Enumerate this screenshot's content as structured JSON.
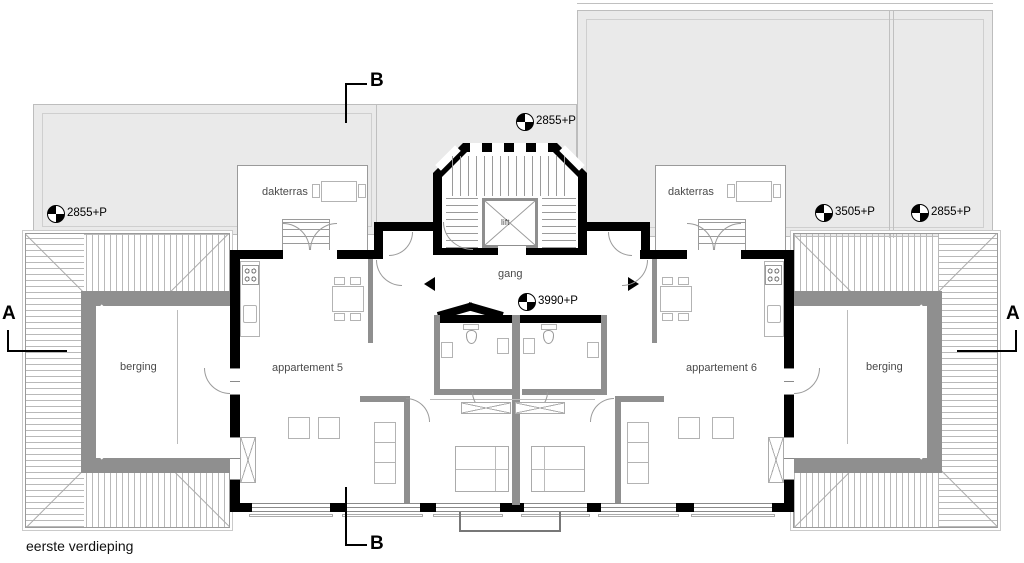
{
  "drawing": {
    "title": "eerste verdieping",
    "type": "architectural floor plan"
  },
  "rooms": {
    "dakterras_left": "dakterras",
    "dakterras_right": "dakterras",
    "berging_left": "berging",
    "berging_right": "berging",
    "apartment_5": "appartement 5",
    "apartment_6": "appartement 6",
    "corridor": "gang",
    "lift": "lift"
  },
  "level_markers": {
    "roof_left": "2855+P",
    "roof_center": "2855+P",
    "roof_right_inner": "3505+P",
    "roof_right_outer": "2855+P",
    "corridor": "3990+P"
  },
  "section_markers": {
    "a_left": "A",
    "a_right": "A",
    "b_top": "B",
    "b_bottom": "B"
  },
  "colors": {
    "wall": "#000000",
    "flat_roof": "#eaeaea",
    "inner_wall": "#8f8f8f",
    "hatch_line": "#b9b9b9",
    "label_text": "#4a4a4a"
  }
}
